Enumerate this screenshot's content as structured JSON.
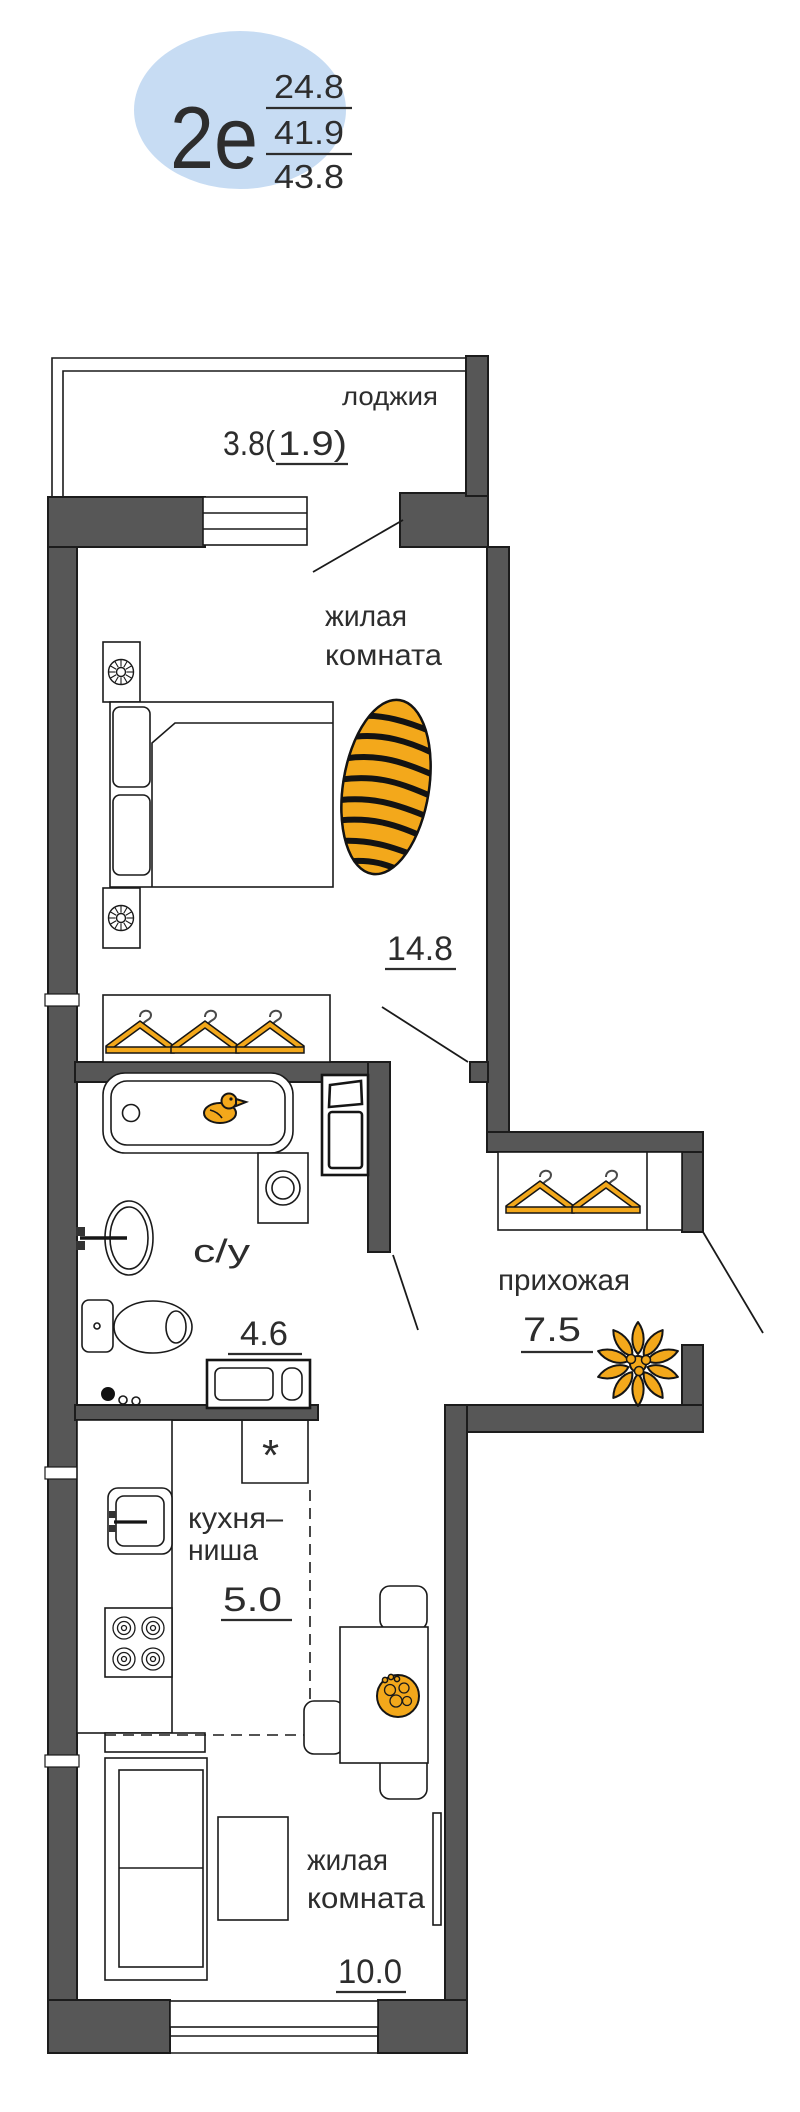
{
  "badge": {
    "type_label": "2е",
    "area_upper": "24.8",
    "area_middle": "41.9",
    "area_lower": "43.8"
  },
  "rooms": {
    "loggia": {
      "name": "лоджия",
      "area_prefix": "3.8(",
      "area_reduced": "1.9)"
    },
    "bedroom": {
      "name_line1": "жилая",
      "name_line2": "комната",
      "area": "14.8"
    },
    "bathroom": {
      "name": "с/у",
      "area": "4.6"
    },
    "hallway": {
      "name": "прихожая",
      "area": "7.5"
    },
    "kitchen": {
      "name_line1": "кухня–",
      "name_line2": "ниша",
      "area": "5.0"
    },
    "living_room": {
      "name_line1": "жилая",
      "name_line2": "комната",
      "area": "10.0"
    }
  },
  "markers": {
    "niche_asterisk": "*"
  },
  "colors": {
    "badge_bg": "#c7dcf3",
    "wall_fill": "#575757",
    "accent_orange": "#f3a81b",
    "line": "#1a1a1a",
    "text": "#2d2d2d"
  }
}
